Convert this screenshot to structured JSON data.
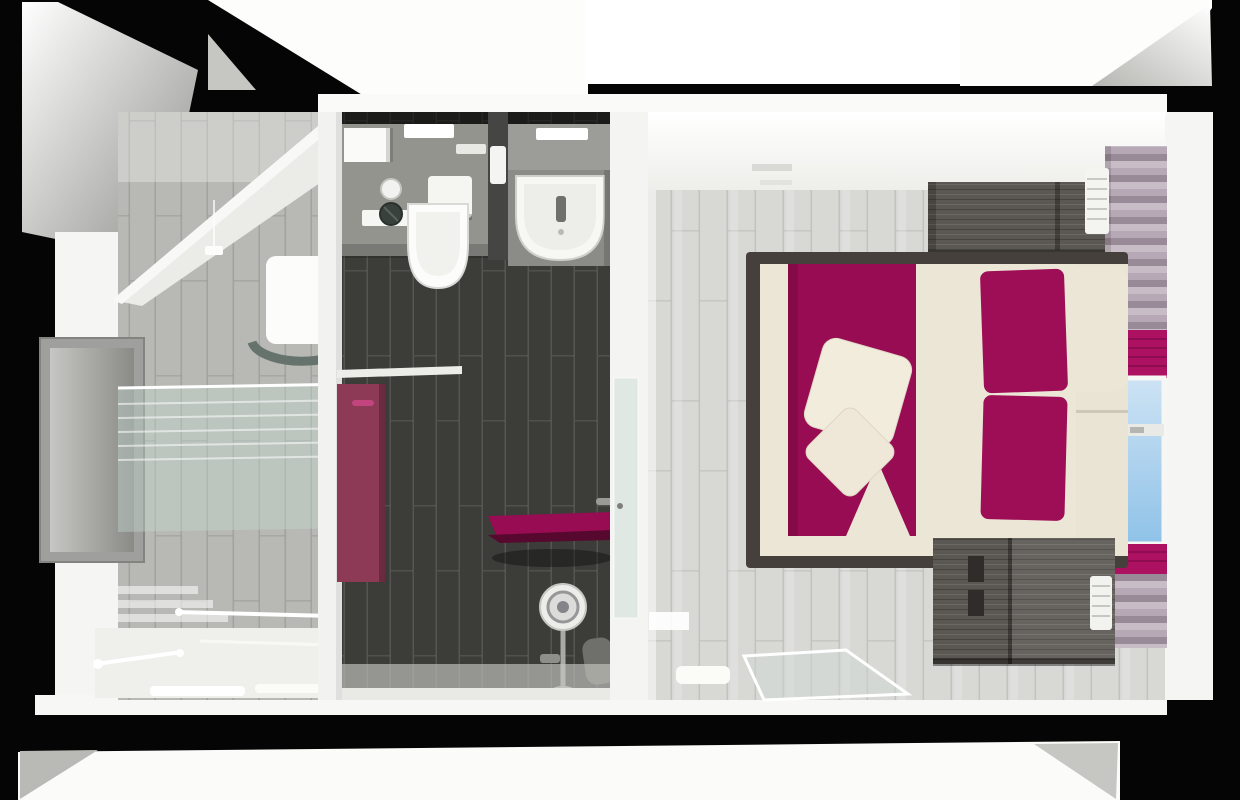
{
  "scene": {
    "title": "3D top-down cutaway floor plan render of a hotel suite",
    "view": "dollhouse / bird's-eye 3D render on black backdrop",
    "rooms": [
      {
        "name": "sauna-bath-room",
        "position": "left",
        "objects": [
          "sloped-attic-ceiling",
          "wall-niche-mirror",
          "glass-screen",
          "round-washbasin",
          "bathtub-with-rails",
          "towels",
          "deck-steps",
          "pendant-light"
        ]
      },
      {
        "name": "shower-room",
        "position": "center",
        "objects": [
          "concealed-cistern",
          "wall-hung-toilet",
          "toilet-paper-roll",
          "shut-off-valve",
          "flush-plate",
          "mirror-with-light",
          "pedestal-sink",
          "magenta-entry-door",
          "wall-shelf",
          "magenta-shower-bench",
          "rain-shower-column",
          "shower-stool",
          "glass-door-to-bedroom"
        ]
      },
      {
        "name": "bedroom",
        "position": "right",
        "objects": [
          "white-ceiling-band",
          "ceiling-vents",
          "wood-headboard-panel",
          "double-bed",
          "cream-duvet",
          "magenta-bed-runner",
          "two-throw-pillows",
          "two-magenta-pillows",
          "cream-bolster-pillows",
          "wood-wardrobe",
          "louver-radiator",
          "striped-roman-curtains",
          "magenta-blinds",
          "window-with-sky",
          "glass-floor-panel",
          "bench-seat"
        ]
      }
    ]
  },
  "palette": {
    "backdrop": "#050505",
    "wall": "#f5f5f3",
    "wall_bright": "#fdfdfc",
    "ceiling": "#fcfcfa",
    "floor_bedroom": "#d8d9d5",
    "floor_sauna": "#b8b9b4",
    "tile_dark": "#3c3c39",
    "wall_gray": "#94948f",
    "wood": "#5b5752",
    "wood_dark_bar": "#38342f",
    "bed_frame": "#45403c",
    "cream": "#ece6d6",
    "pillow_cream": "#f2ecdc",
    "magenta": "#970c52",
    "magenta_pillow": "#9d0e57",
    "accent_bright": "#ad1162",
    "door_magenta": "#8c3a55",
    "door_handle": "#c2457e",
    "bench_edge": "#57082f",
    "curtain_a": "#b7a8b5",
    "curtain_b": "#998a97",
    "curtain_c": "#c8bcc6",
    "sky": "#8fc2e8",
    "sky_light": "#cde3f4",
    "glass": "rgba(196,214,208,0.42)",
    "fixture_gray": "#9a9a96",
    "niche_gray": "#9f9f9d"
  }
}
